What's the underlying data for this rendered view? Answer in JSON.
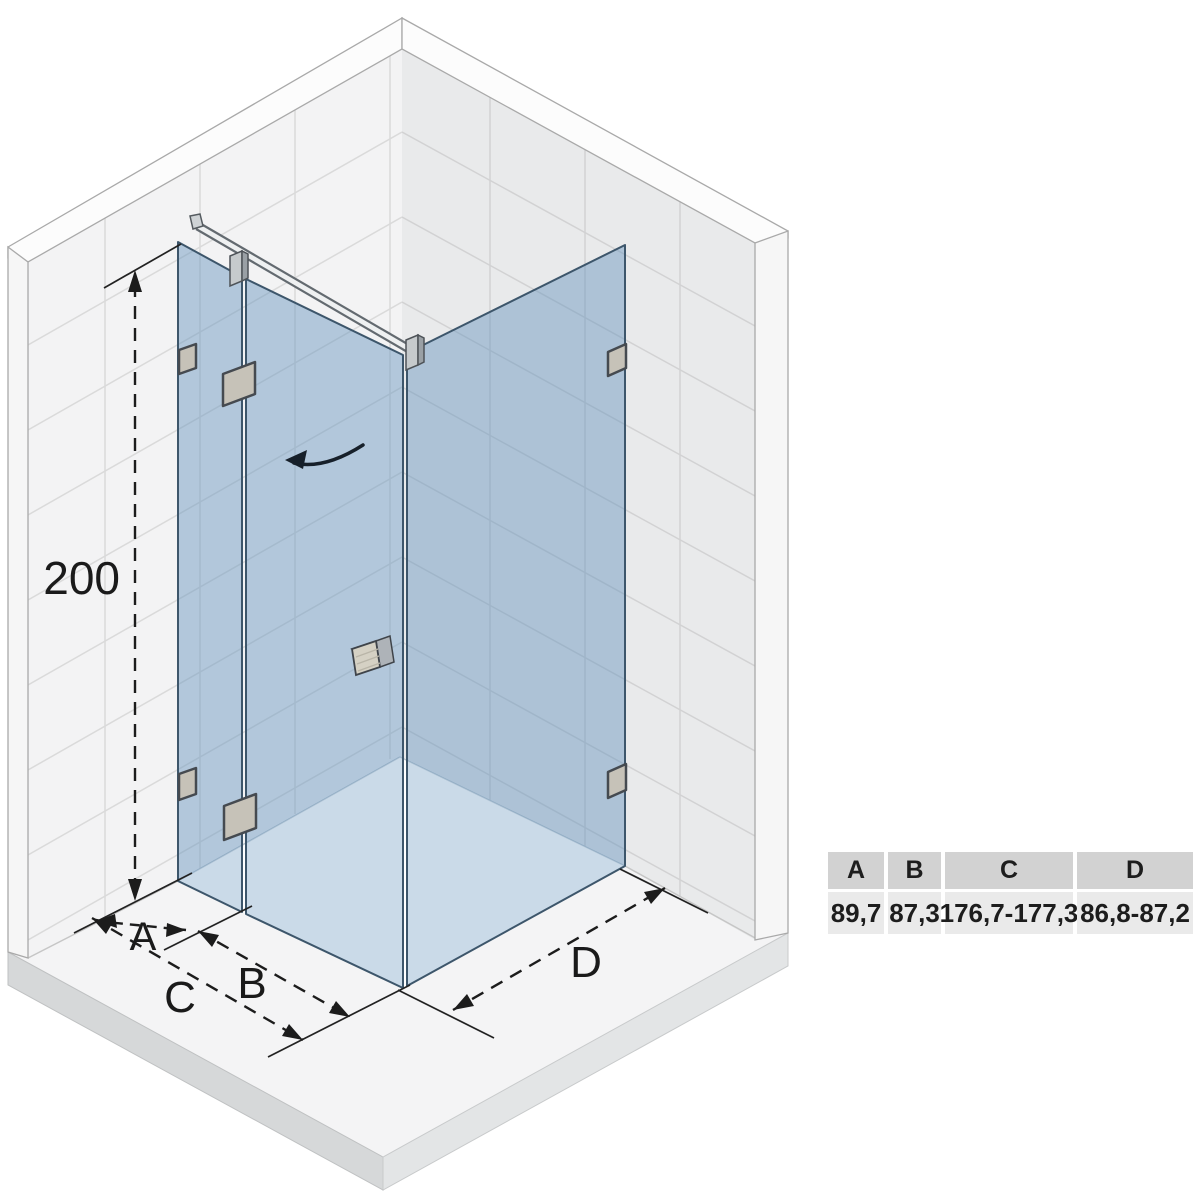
{
  "diagram": {
    "height_dimension": "200",
    "width_dimension_a": "A",
    "width_dimension_b": "B",
    "width_dimension_c": "C",
    "width_dimension_d": "D"
  },
  "table": {
    "headers": [
      "A",
      "B",
      "C",
      "D"
    ],
    "values": [
      "89,7",
      "87,3",
      "176,7-177,3",
      "86,8-87,2"
    ]
  },
  "colors": {
    "glass": "#b7cfe2",
    "glass_edge": "#3d566b",
    "wall_left": "#f3f3f4",
    "wall_right": "#e9eaeb",
    "tile_line": "#d8d8d8",
    "floor": "#f4f4f5",
    "tray": "#ffffff",
    "hardware": "#c6c2b8",
    "dimension_line": "#1c1c1c",
    "table_header_bg": "#d2d2d2",
    "table_row_bg": "#eaeaea"
  }
}
